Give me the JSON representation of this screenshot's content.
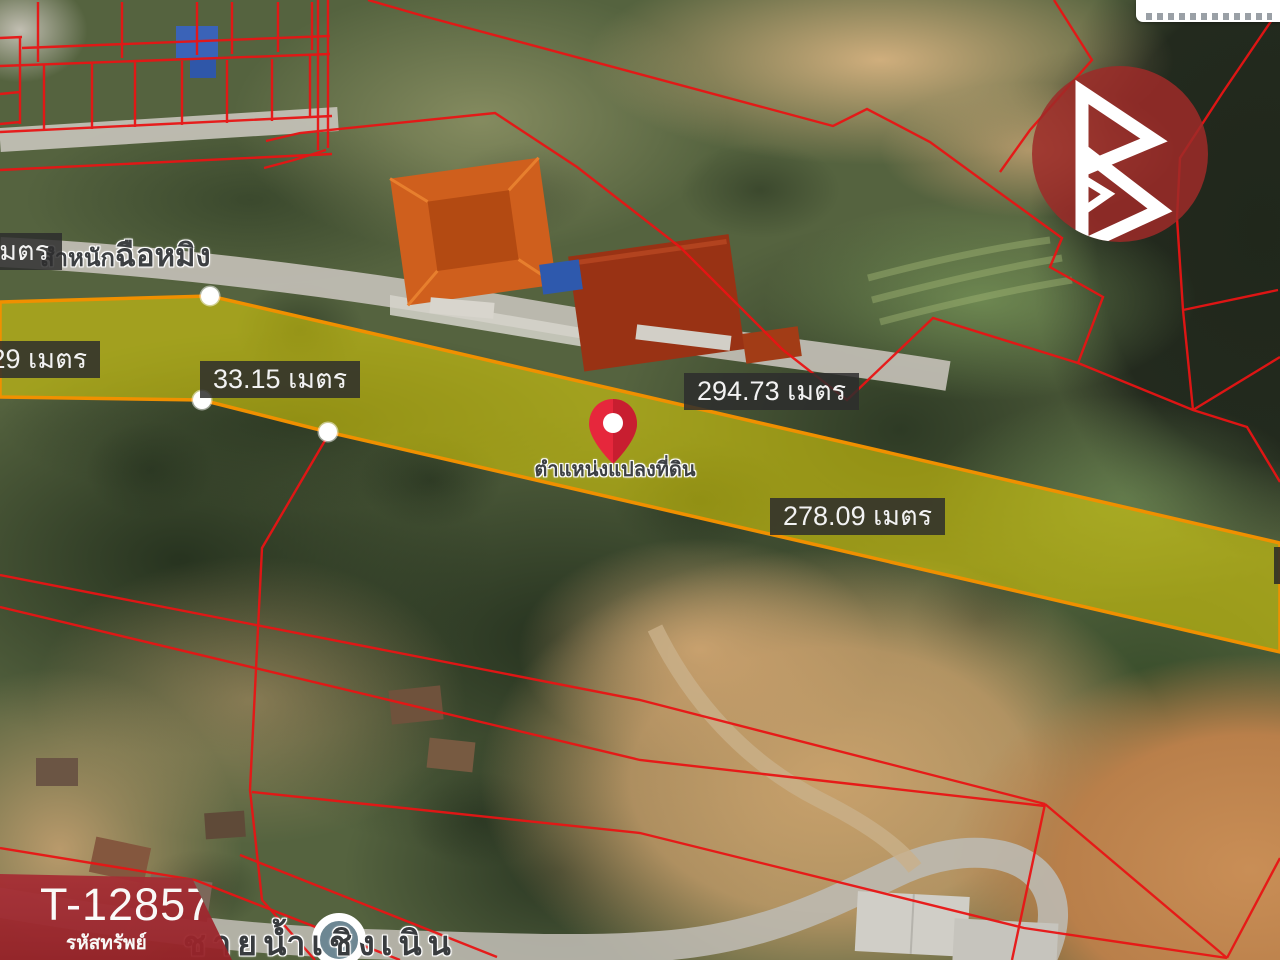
{
  "map": {
    "measurements": [
      {
        "value": ".00 เมตร"
      },
      {
        "value": "5.29 เมตร"
      },
      {
        "value": "33.15 เมตร"
      },
      {
        "value": "294.73 เมตร"
      },
      {
        "value": "278.09 เมตร"
      }
    ],
    "pin_label": "ตำแหน่งแปลงที่ดิน",
    "road_label_top_part1": "สำหนัก",
    "road_label_top_part2": "ฉือหมิง",
    "road_label_bottom": "ชายน้ำเชิงเนิน"
  },
  "banner": {
    "code": "T-128575",
    "caption": "รหัสทรัพย์"
  },
  "colors": {
    "parcel_line": "#e81414",
    "plot_fill": "#d4c700",
    "plot_border": "#f09000",
    "banner_bg": "#a02b31",
    "pin_red": "#e6273c",
    "logo_circle": "#9e2a28",
    "poi_fill": "#6d8793"
  }
}
